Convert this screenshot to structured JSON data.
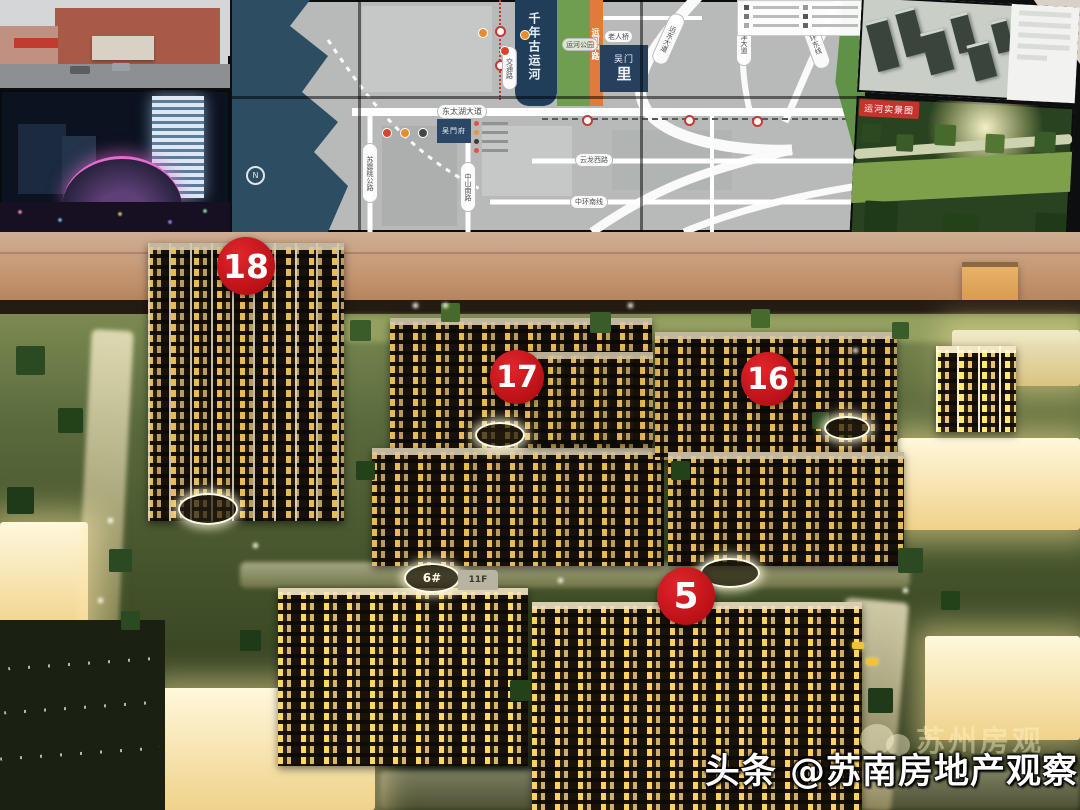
{
  "screen_wall": {
    "map": {
      "canal_label": "千年古运河",
      "canal_road_label": "交通路",
      "park_label": "运河公园",
      "canal_mid_road_label": "运河中路",
      "project_line1": "吴门",
      "project_line2": "里",
      "bridge_label": "老人桥",
      "yundong_ave_label": "运东大道",
      "jin_ave_label": "津大道",
      "zhonghuan_east_label": "中环东线",
      "east_taihu_ave_label": "东太湖大道",
      "wumenfu_label": "吴門府",
      "yunlong_west_label": "云龙西路",
      "zhonghuan_south_label": "中环南线",
      "zhongshan_south_label": "中山南路",
      "suzhentao_label": "苏震桃公路",
      "compass_label": "N"
    },
    "park_photo_tag": "运河实景图"
  },
  "model": {
    "badges": [
      {
        "label": "18"
      },
      {
        "label": "17"
      },
      {
        "label": "16"
      },
      {
        "label": "5"
      }
    ],
    "signs": {
      "building6": "6#",
      "floors": "11F"
    }
  },
  "watermark": {
    "platform": "头条 ",
    "account": "@苏南房地产观察",
    "ghost": "苏州房观"
  },
  "colors": {
    "badge_red": "#c9171e",
    "map_water": "#2d4d63",
    "map_park_green": "#6f9e4e",
    "road_orange": "#e07b39",
    "tag_red": "#c4342c"
  }
}
